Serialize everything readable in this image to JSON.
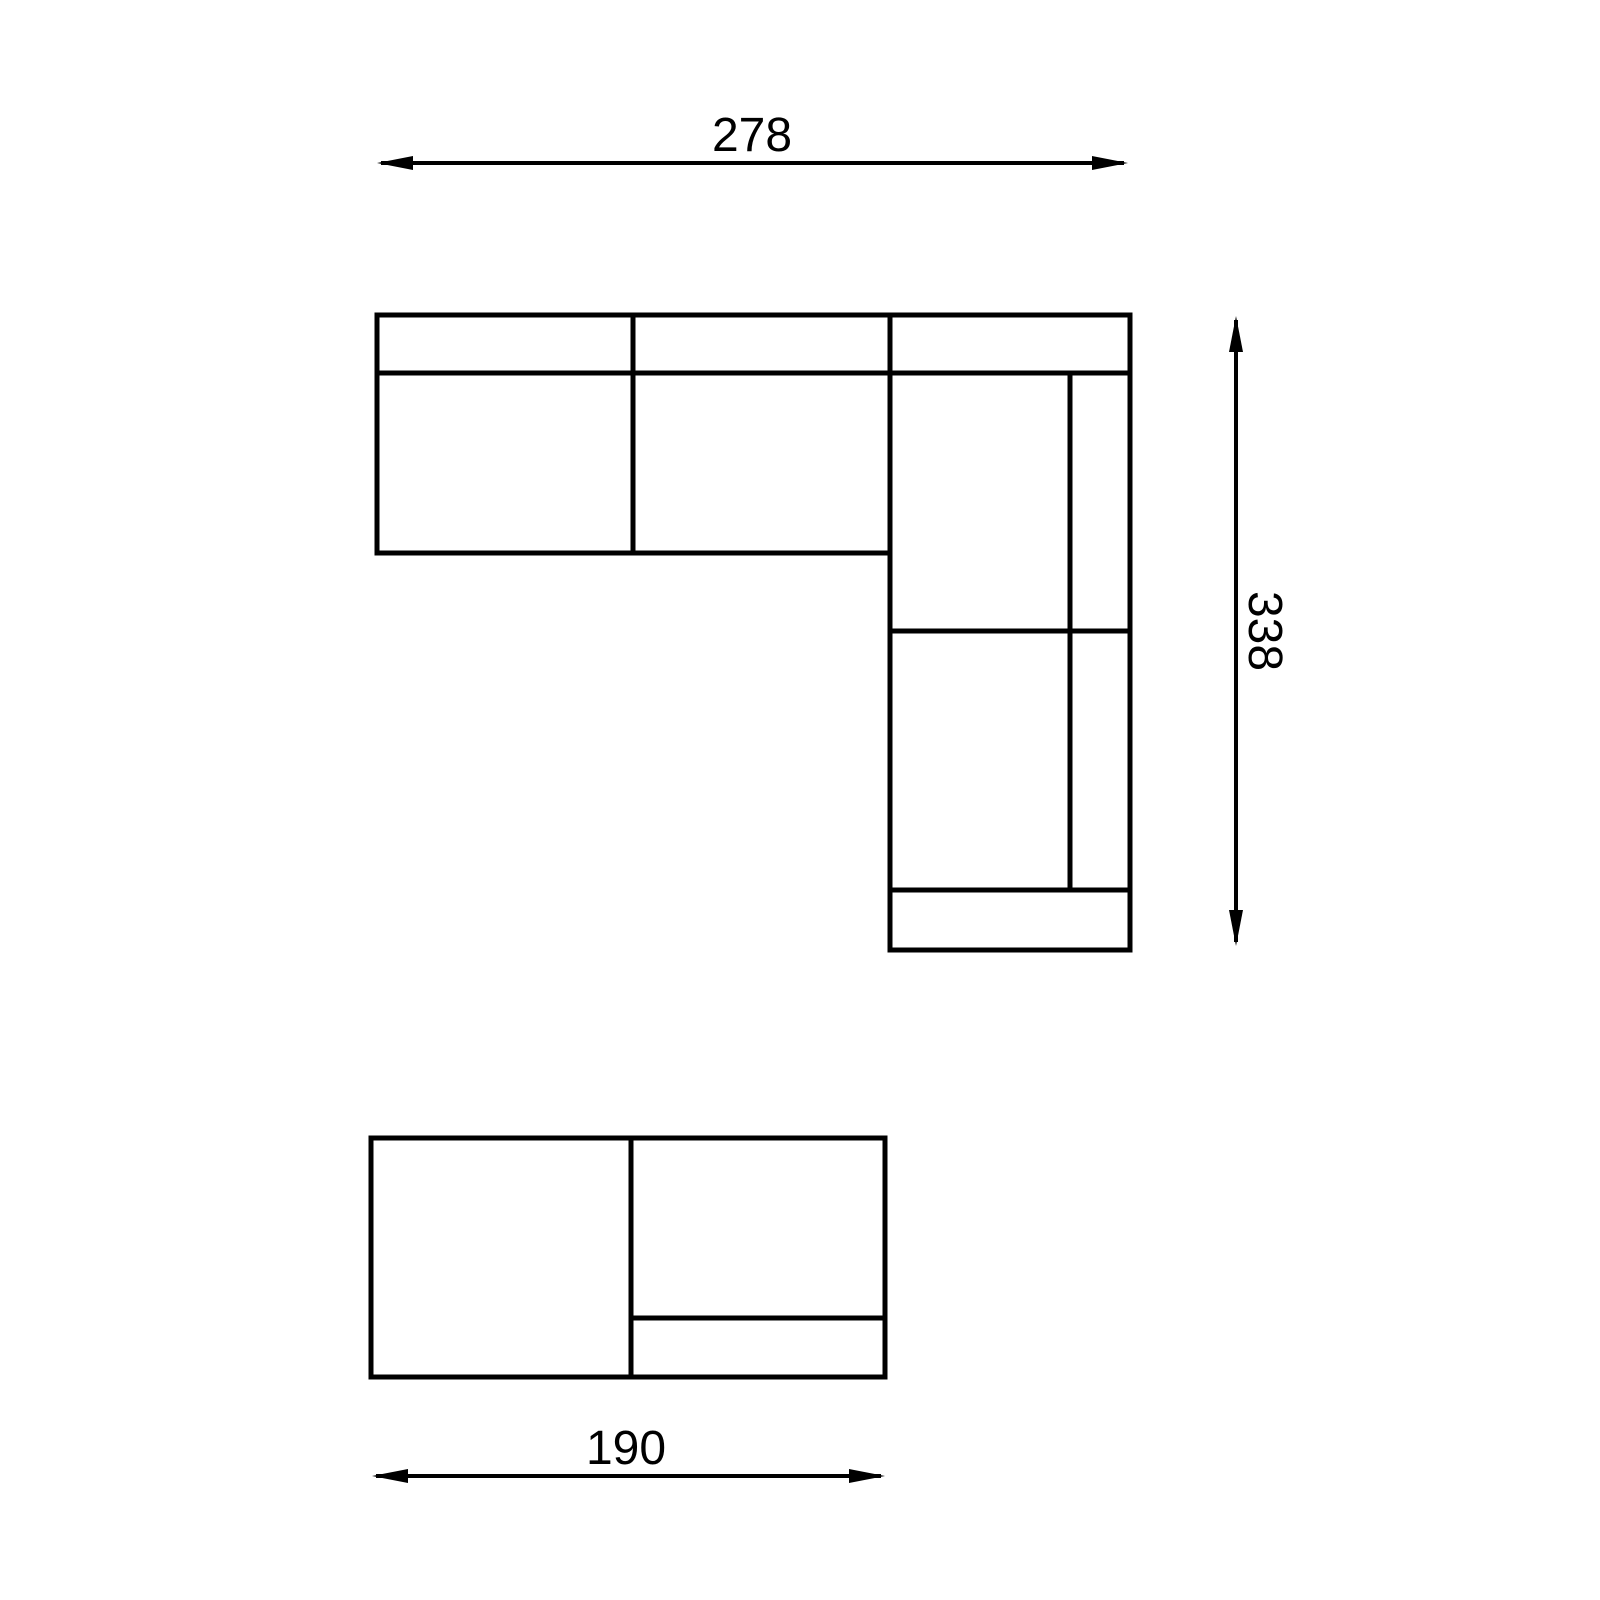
{
  "drawing": {
    "title": "sectional-sofa-plan-technical-drawing",
    "dimensions": {
      "top_width": "278",
      "right_height": "338",
      "bottom_width": "190"
    },
    "colors": {
      "line": "#000000",
      "background": "#ffffff"
    }
  }
}
